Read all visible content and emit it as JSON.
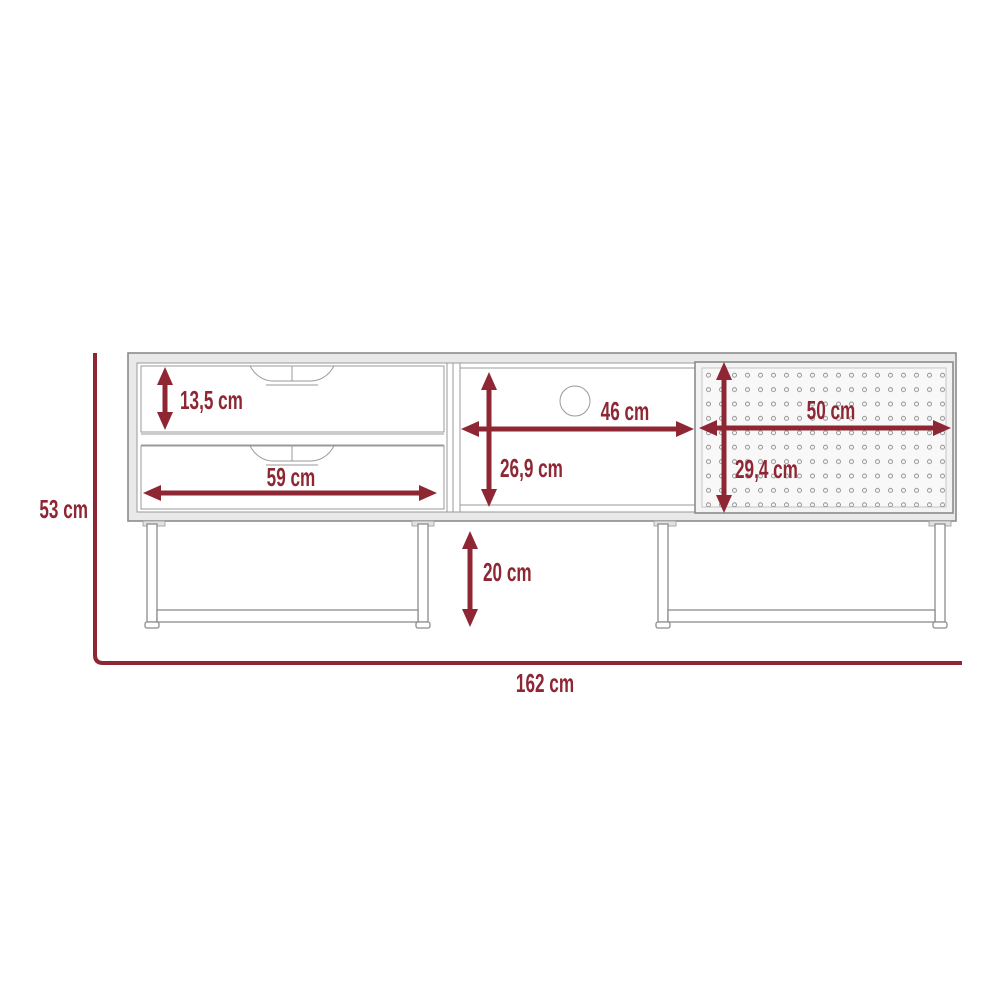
{
  "diagram": {
    "type": "furniture-dimension-drawing",
    "subject": "tv-stand with two drawers, open shelf with cable hole, perforated sliding door and two u-shaped metal legs",
    "unit": "cm",
    "colors": {
      "dimension_accent": "#8e2733",
      "furniture_outline": "#8c8c8c",
      "panel_fill": "#e9e9e9",
      "door_fill": "#f3f3f3",
      "background": "#ffffff"
    },
    "dimensions": {
      "drawer_height": {
        "label": "13,5 cm",
        "value": 13.5,
        "orientation": "vertical",
        "part": "top drawer height"
      },
      "drawer_width": {
        "label": "59 cm",
        "value": 59,
        "orientation": "horizontal",
        "part": "drawer width"
      },
      "shelf_height": {
        "label": "26,9 cm",
        "value": 26.9,
        "orientation": "vertical",
        "part": "open shelf height"
      },
      "shelf_width": {
        "label": "46 cm",
        "value": 46,
        "orientation": "horizontal",
        "part": "open shelf width"
      },
      "door_height": {
        "label": "29,4 cm",
        "value": 29.4,
        "orientation": "vertical",
        "part": "perforated door height"
      },
      "door_width": {
        "label": "50 cm",
        "value": 50,
        "orientation": "horizontal",
        "part": "perforated door width"
      },
      "leg_height": {
        "label": "20 cm",
        "value": 20,
        "orientation": "vertical",
        "part": "leg height"
      },
      "total_height": {
        "label": "53 cm",
        "value": 53,
        "orientation": "vertical",
        "part": "overall height"
      },
      "total_width": {
        "label": "162 cm",
        "value": 162,
        "orientation": "horizontal",
        "part": "overall width"
      }
    }
  }
}
